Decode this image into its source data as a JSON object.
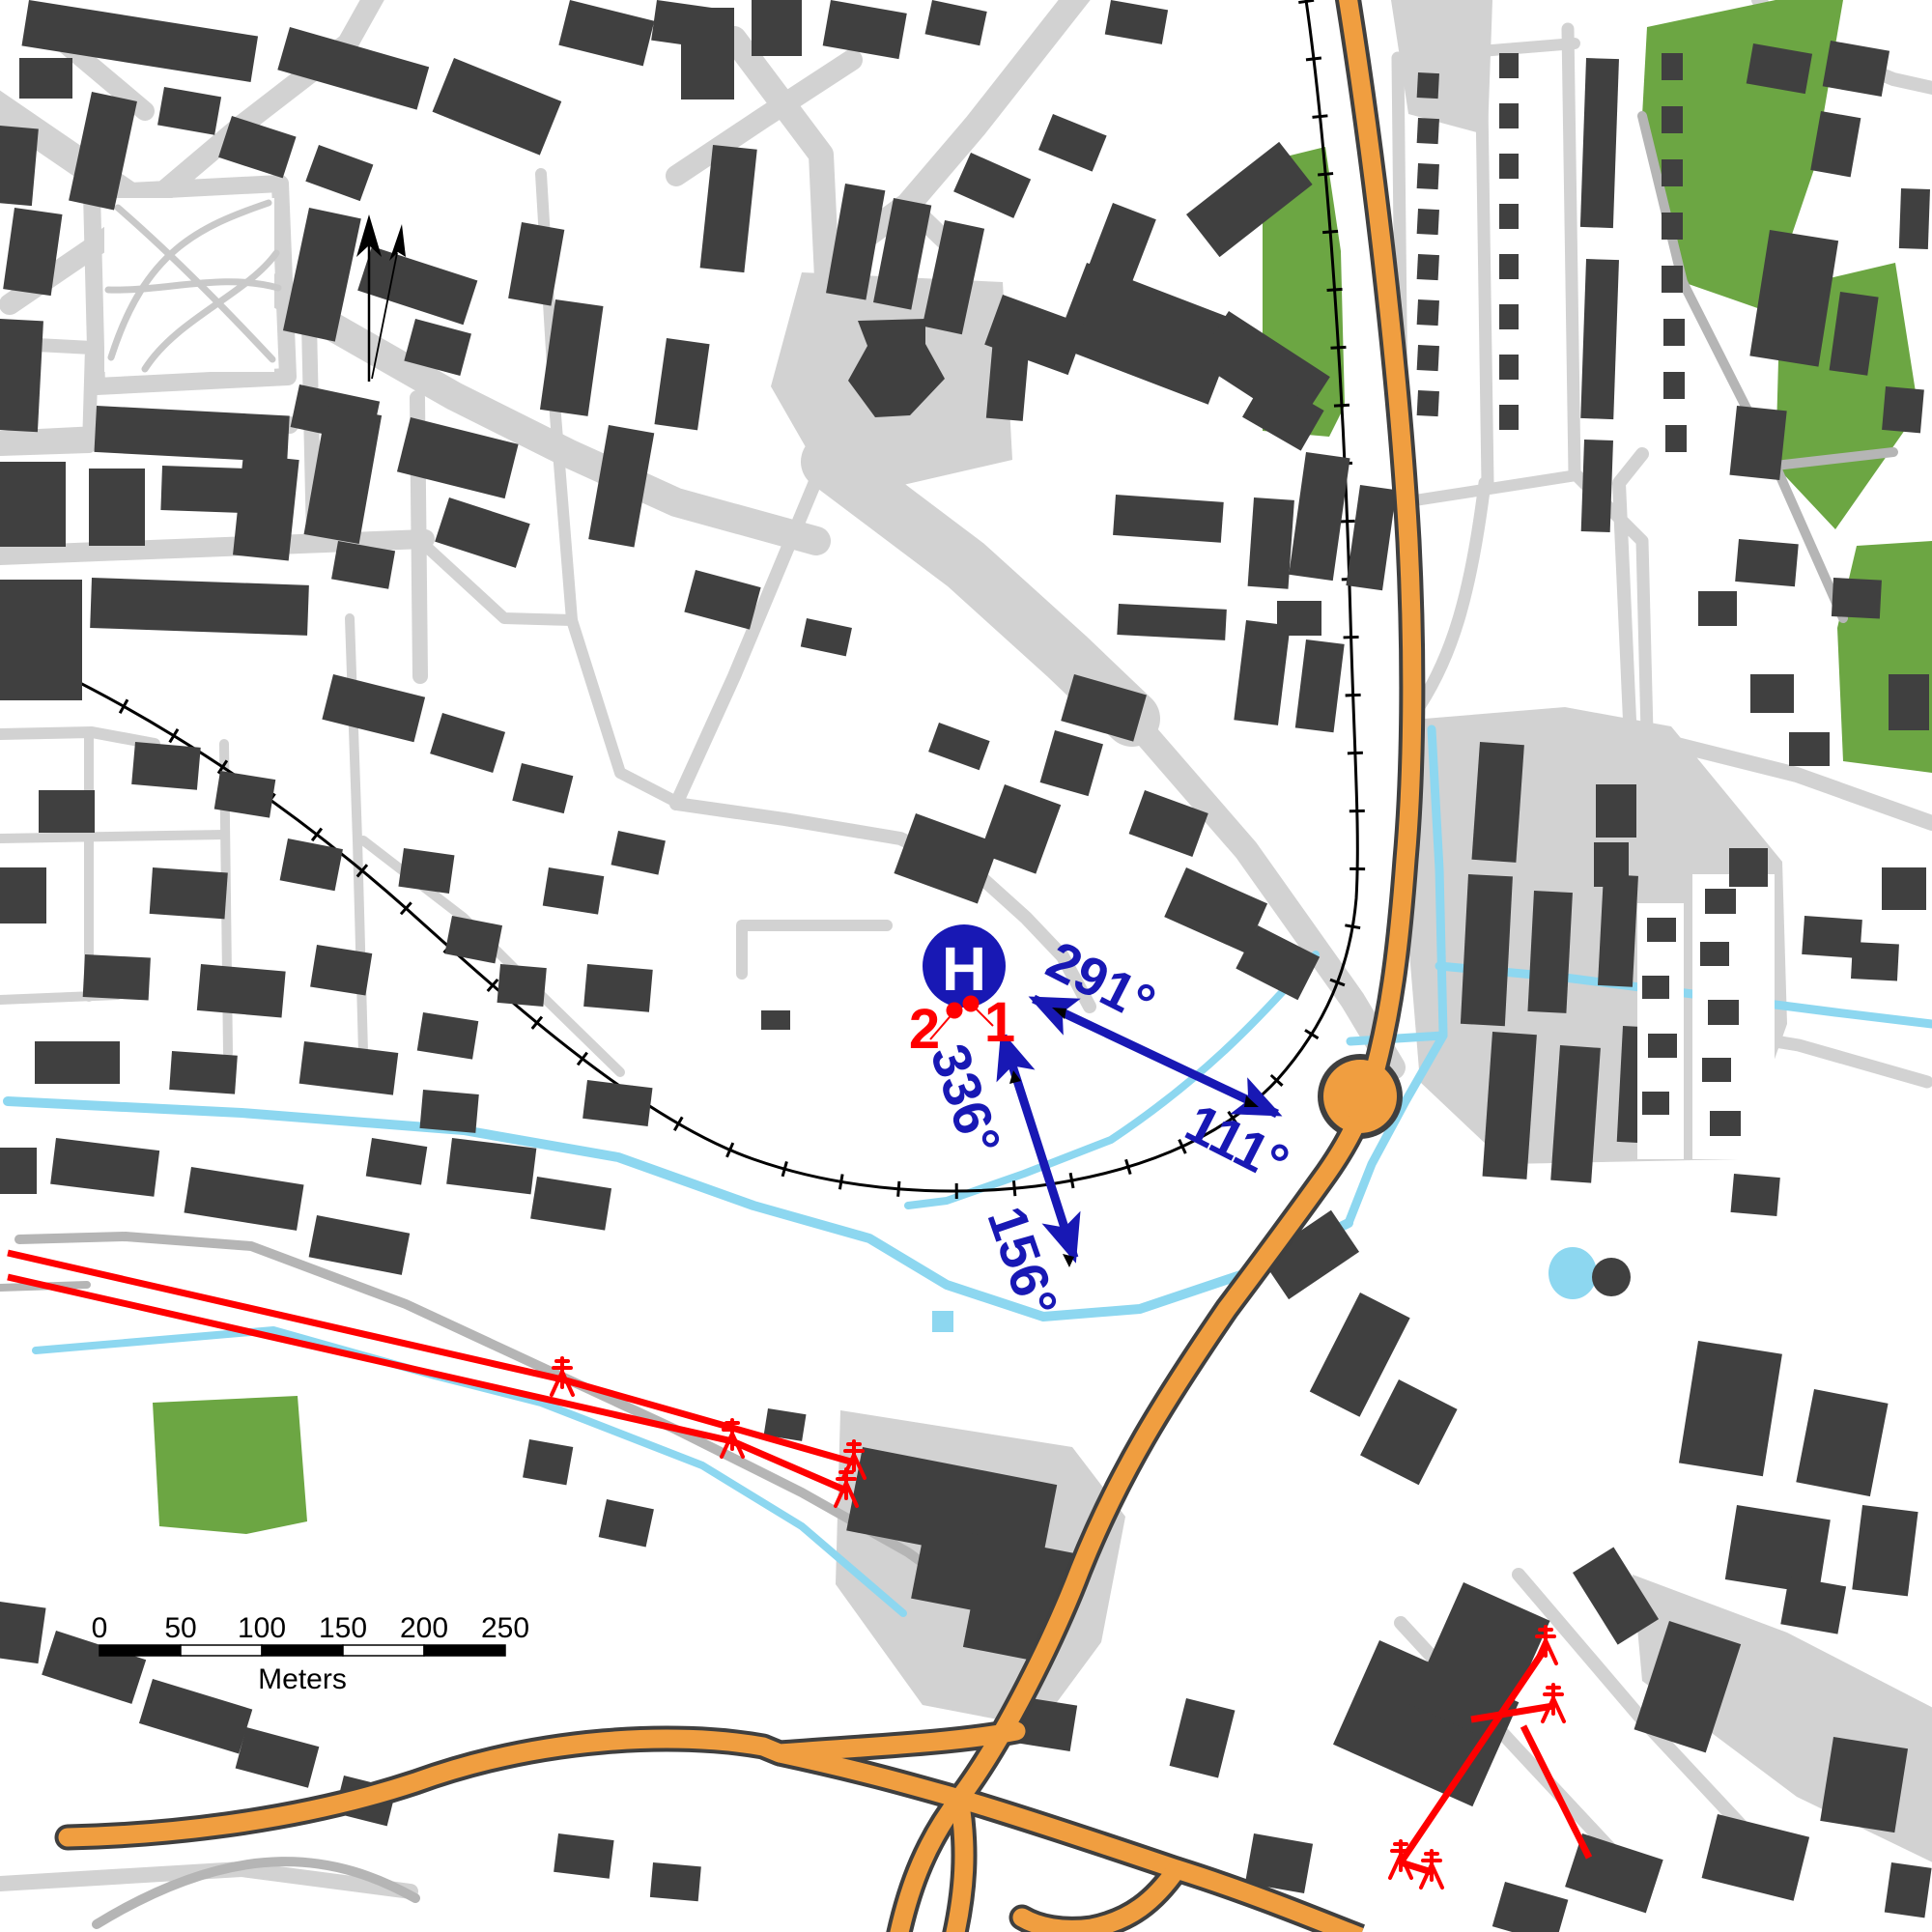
{
  "map": {
    "helipad": {
      "symbol": "H"
    },
    "landing_points": [
      {
        "label": "1"
      },
      {
        "label": "2"
      }
    ],
    "approach_arrows": [
      {
        "labels": [
          "291°",
          "111°"
        ]
      },
      {
        "labels": [
          "336°",
          "156°"
        ]
      }
    ],
    "scale_bar": {
      "tick_labels": [
        "0",
        "50",
        "100",
        "150",
        "200",
        "250"
      ],
      "unit_label": "Meters"
    },
    "colors": {
      "background": "#ffffff",
      "building": "#404040",
      "road": "#d2d2d2",
      "road_minor": "#b5b5b5",
      "green_area": "#6CA643",
      "water": "#8DD7F0",
      "highway_fill": "#F09E40",
      "highway_casing": "#3f3f3f",
      "railway": "#000000",
      "symbol_blue": "#1818B4",
      "symbol_red": "#FF0000"
    }
  }
}
